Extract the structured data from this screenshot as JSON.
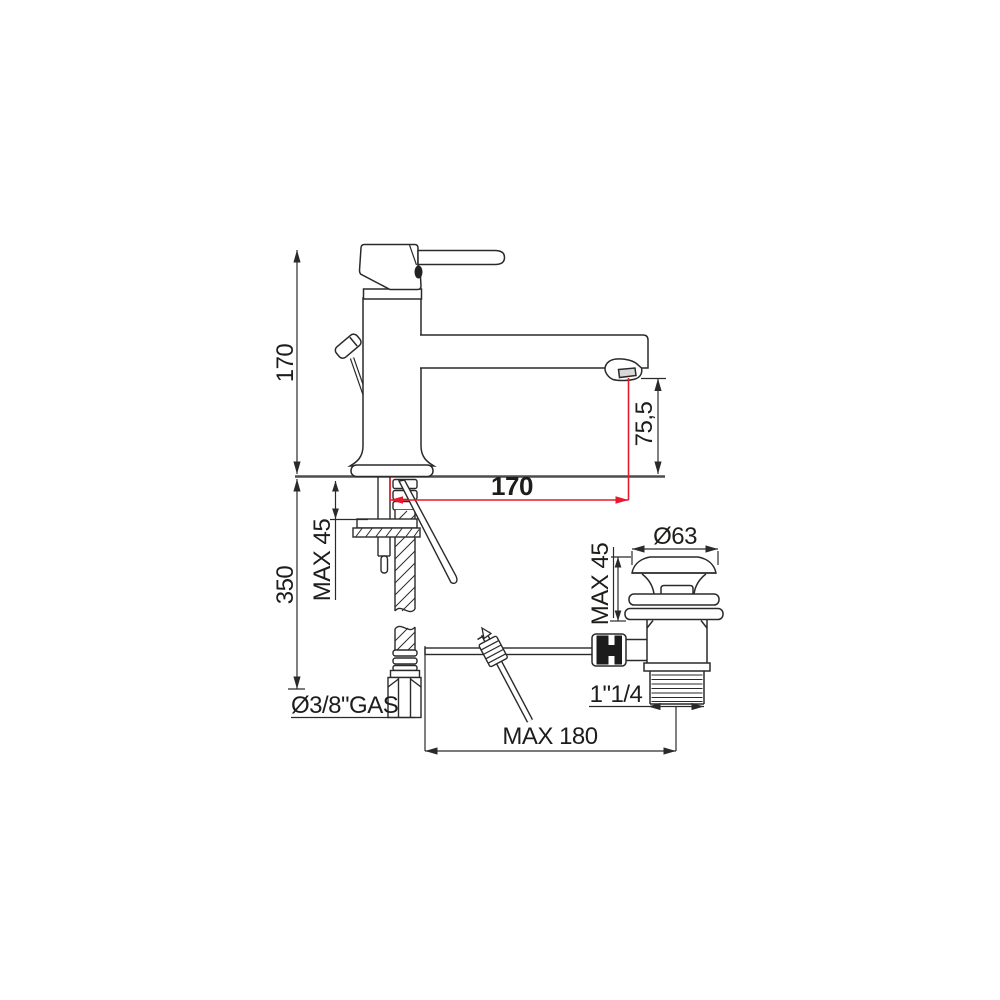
{
  "drawing": {
    "title": "single-lever basin mixer with pop-up waste - dimensional technical drawing",
    "colors": {
      "line": "#2a2a2a",
      "accent_red": "#e8192c",
      "counter_line": "#4d4d4d",
      "background": "#ffffff"
    },
    "labels": {
      "total_height": "170",
      "under_counter_depth": "350",
      "counter_thickness_max": "MAX 45",
      "spout_outlet_height": "75,5",
      "spout_reach": "170",
      "waste_flange_diameter": "Ø63",
      "waste_counter_max": "MAX 45",
      "waste_thread_size": "1\"1/4",
      "linkage_max_length": "MAX 180",
      "supply_connection": "Ø3/8\"GAS"
    }
  }
}
